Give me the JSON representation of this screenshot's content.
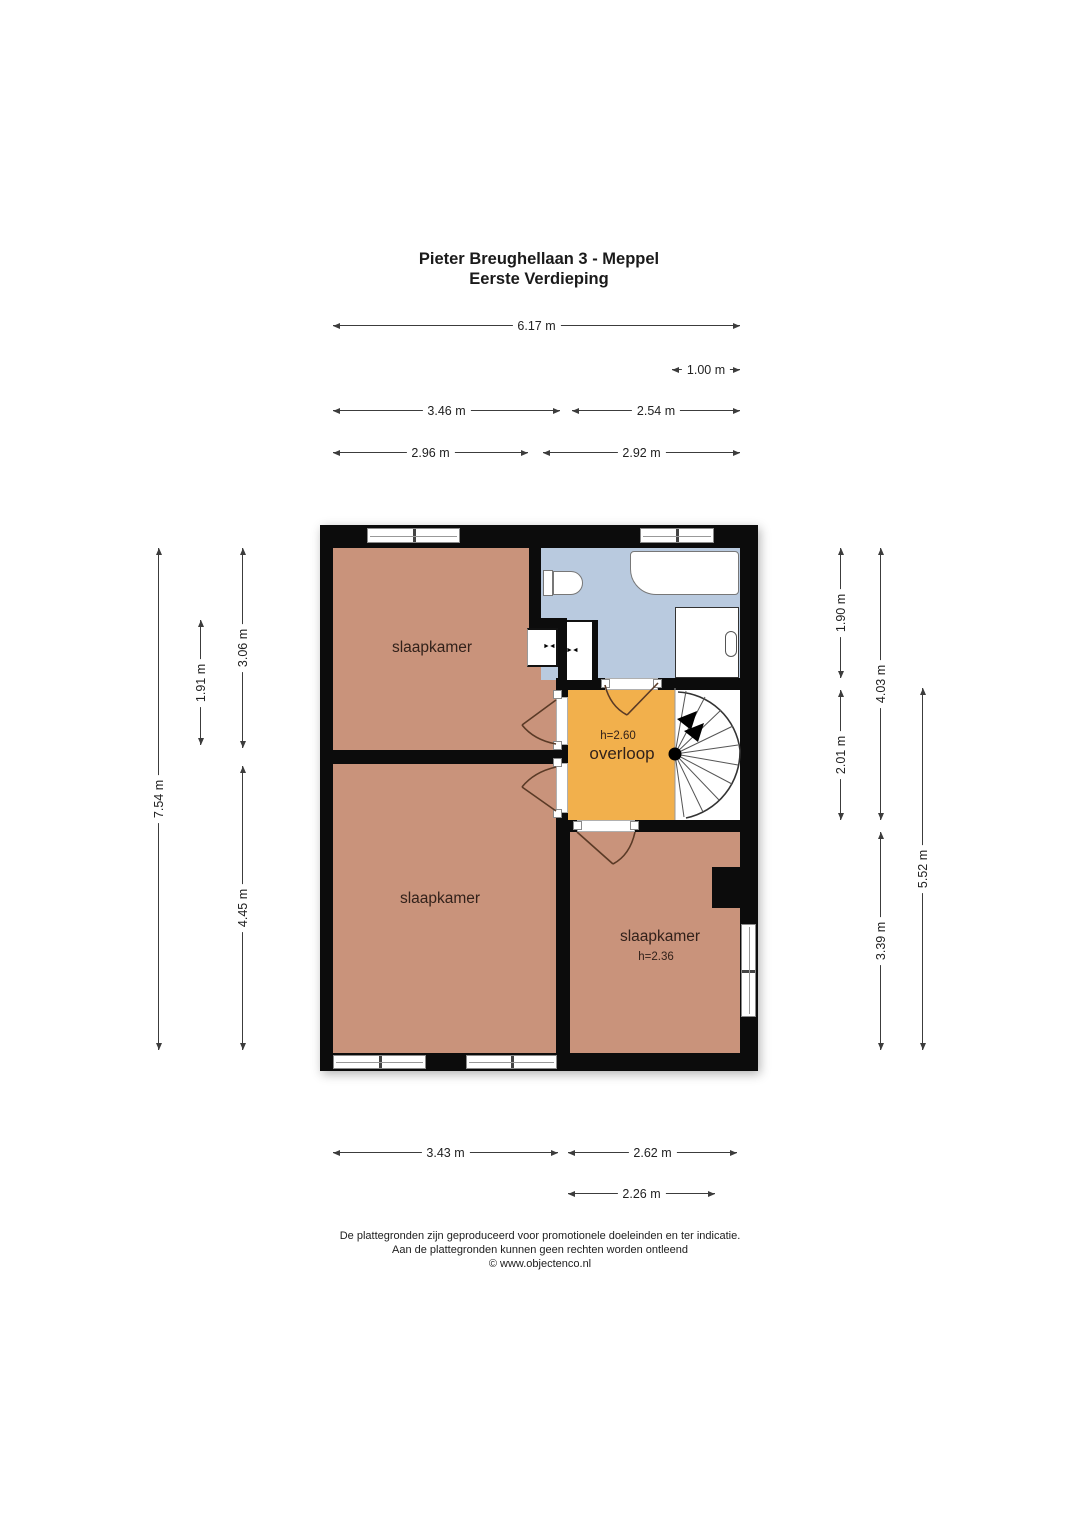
{
  "title": {
    "line1": "Pieter Breughellaan 3 - Meppel",
    "line2": "Eerste Verdieping"
  },
  "rooms": {
    "bedroom_top_left": {
      "label": "slaapkamer"
    },
    "bedroom_bottom_left": {
      "label": "slaapkamer"
    },
    "bedroom_bottom_right": {
      "label": "slaapkamer",
      "height_note": "h=2.36"
    },
    "landing": {
      "label": "overloop",
      "height_note": "h=2.60"
    }
  },
  "dimensions": {
    "top_total": "6.17 m",
    "top_stairs": "1.00 m",
    "top_left_section": "3.46 m",
    "top_right_section": "2.54 m",
    "top_bedroom1": "2.96 m",
    "top_bathroom": "2.92 m",
    "bottom_bedroom2": "3.43 m",
    "bottom_bedroom3": "2.62 m",
    "bottom_bedroom3_inner": "2.26 m",
    "left_total": "7.54 m",
    "left_bedroom1": "3.06 m",
    "left_closet": "1.91 m",
    "left_bedroom2": "4.45 m",
    "right_bathroom": "1.90 m",
    "right_landing": "2.01 m",
    "right_upper": "4.03 m",
    "right_bedroom3": "3.39 m",
    "right_lower": "5.52 m"
  },
  "icons": {
    "vent": "►◄"
  },
  "footer": {
    "line1": "De plattegronden zijn geproduceerd voor promotionele doeleinden en ter indicatie.",
    "line2": "Aan de plattegronden kunnen geen rechten worden ontleend",
    "line3": "© www.objectenco.nl"
  },
  "colors": {
    "wall": "#0c0c0c",
    "bedroom": "#c9937b",
    "bathroom": "#b9cadf",
    "landing": "#f2b04c",
    "door_arc": "#5a3a26",
    "dim_line": "#3c3c3c"
  }
}
